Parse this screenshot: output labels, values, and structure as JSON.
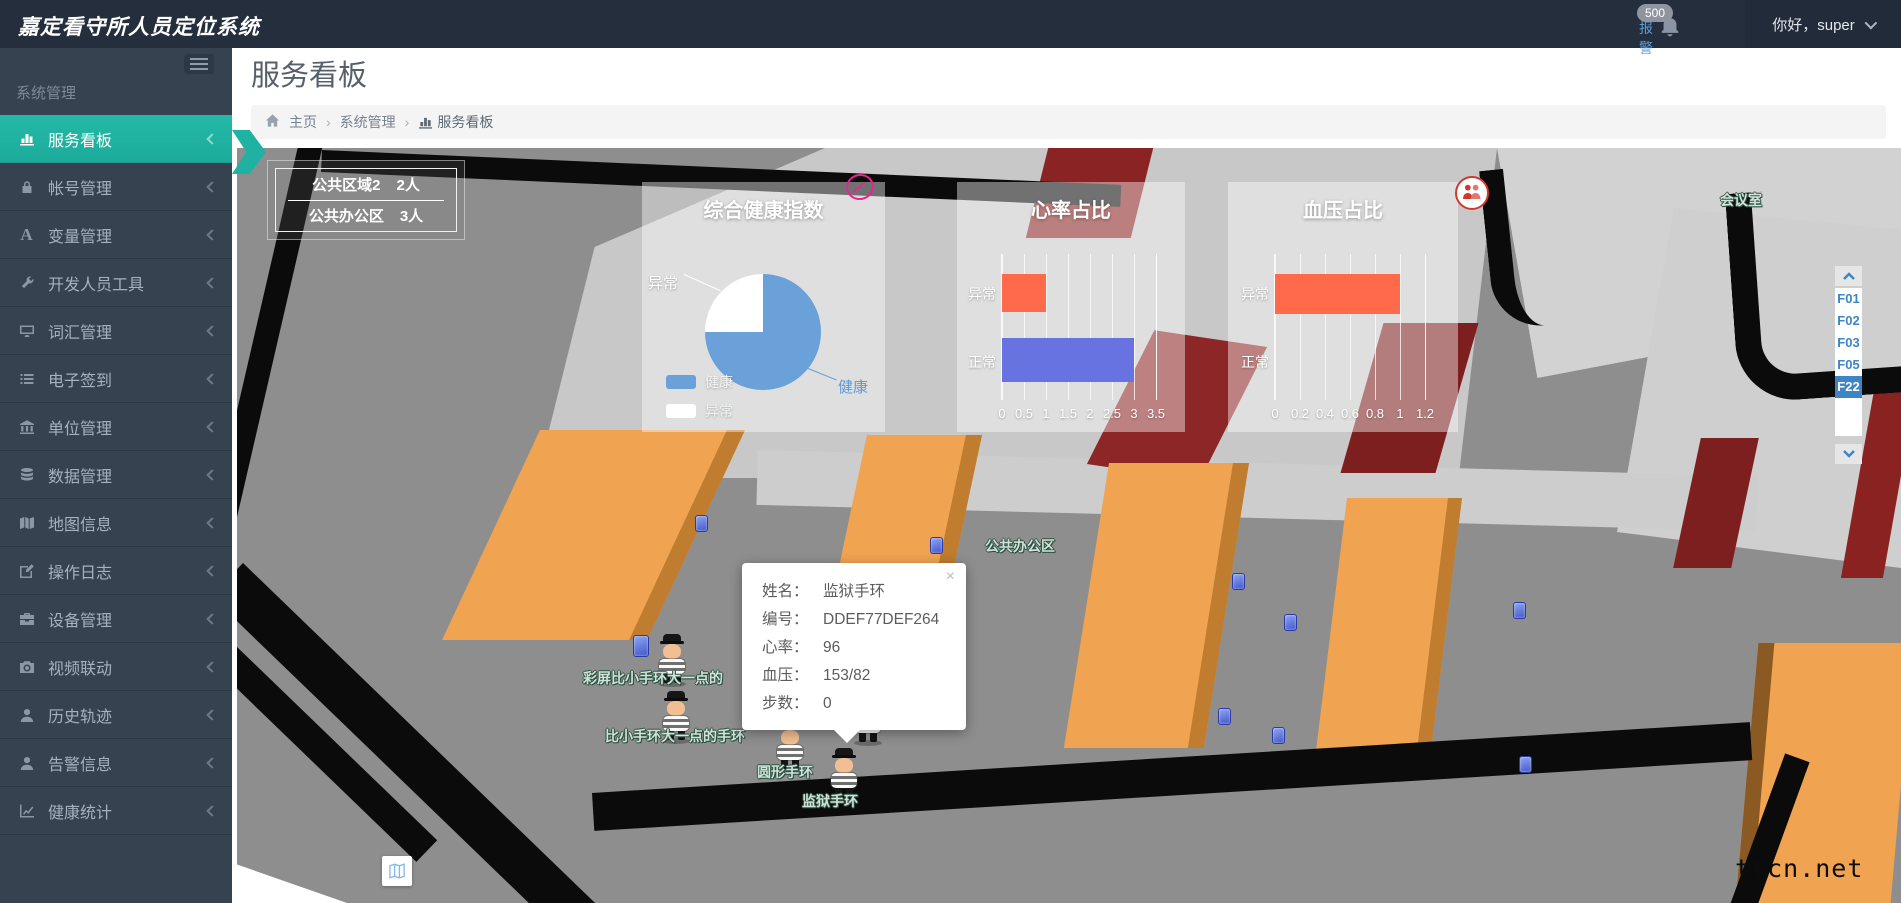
{
  "header": {
    "app_title": "嘉定看守所人员定位系统",
    "alarm_label": "报警",
    "alarm_count": "500",
    "greeting": "你好，super"
  },
  "sidebar": {
    "section_label": "系统管理",
    "items": [
      {
        "label": "服务看板",
        "icon": "bar-chart-icon",
        "active": true
      },
      {
        "label": "帐号管理",
        "icon": "lock-icon"
      },
      {
        "label": "变量管理",
        "icon": "font-icon"
      },
      {
        "label": "开发人员工具",
        "icon": "wrench-icon"
      },
      {
        "label": "词汇管理",
        "icon": "monitor-icon"
      },
      {
        "label": "电子签到",
        "icon": "list-icon"
      },
      {
        "label": "单位管理",
        "icon": "bank-icon"
      },
      {
        "label": "数据管理",
        "icon": "database-icon"
      },
      {
        "label": "地图信息",
        "icon": "map-icon"
      },
      {
        "label": "操作日志",
        "icon": "edit-icon"
      },
      {
        "label": "设备管理",
        "icon": "briefcase-icon"
      },
      {
        "label": "视频联动",
        "icon": "camera-icon"
      },
      {
        "label": "历史轨迹",
        "icon": "user-icon"
      },
      {
        "label": "告警信息",
        "icon": "user-icon"
      },
      {
        "label": "健康统计",
        "icon": "trend-icon"
      }
    ]
  },
  "page": {
    "title": "服务看板",
    "breadcrumb": [
      "主页",
      "系统管理",
      "服务看板"
    ]
  },
  "map": {
    "region_stats": [
      {
        "name": "公共区域2",
        "count": "2人"
      },
      {
        "name": "公共办公区",
        "count": "3人"
      }
    ],
    "floor_selector": {
      "floors": [
        "F01",
        "F02",
        "F03",
        "F05",
        "F22"
      ],
      "selected": "F22"
    },
    "area_labels": [
      "公共办公区",
      "会议室"
    ],
    "device_labels": [
      "彩屏比小手环大一点的",
      "比小手环大一点的手环",
      "圆形手环",
      "圆心手环三",
      "监狱手环"
    ],
    "tooltip": {
      "rows": [
        {
          "label": "姓名：",
          "value": "监狱手环"
        },
        {
          "label": "编号：",
          "value": "DDEF77DEF264"
        },
        {
          "label": "心率：",
          "value": "96"
        },
        {
          "label": "血压：",
          "value": "153/82"
        },
        {
          "label": "步数：",
          "value": "0"
        }
      ]
    },
    "watermark": "ttcn.net"
  },
  "chart_data": [
    {
      "type": "pie",
      "title": "综合健康指数",
      "labels": [
        "健康",
        "异常"
      ],
      "values": [
        3,
        1
      ],
      "percents": [
        75,
        25
      ],
      "colors": [
        "#6aa1d8",
        "#ffffff"
      ],
      "legend_position": "bottom-left",
      "callouts": [
        "异常",
        "健康"
      ]
    },
    {
      "type": "bar",
      "orientation": "horizontal",
      "title": "心率占比",
      "categories": [
        "异常",
        "正常"
      ],
      "values": [
        1,
        3
      ],
      "colors": [
        "#ff6b4a",
        "#6673e0"
      ],
      "xlim": [
        0,
        3.5
      ],
      "ticks": [
        "0",
        "0.5",
        "1",
        "1.5",
        "2",
        "2.5",
        "3",
        "3.5"
      ],
      "grid": true
    },
    {
      "type": "bar",
      "orientation": "horizontal",
      "title": "血压占比",
      "categories": [
        "异常",
        "正常"
      ],
      "values": [
        1,
        0
      ],
      "colors": [
        "#ff6b4a",
        "#6673e0"
      ],
      "xlim": [
        0,
        1.2
      ],
      "ticks": [
        "0",
        "0.2",
        "0.4",
        "0.6",
        "0.8",
        "1",
        "1.2"
      ],
      "grid": true
    }
  ],
  "colors": {
    "accent": "#1fb2a2",
    "alarm_blue": "#5b9bd5",
    "pie_health": "#6aa1d8",
    "bar_abnormal": "#ff6b4a",
    "bar_normal": "#6673e0",
    "floor_selected": "#3d85c6",
    "block_orange": "#f0a351",
    "block_darkred": "#7e1f1f"
  }
}
